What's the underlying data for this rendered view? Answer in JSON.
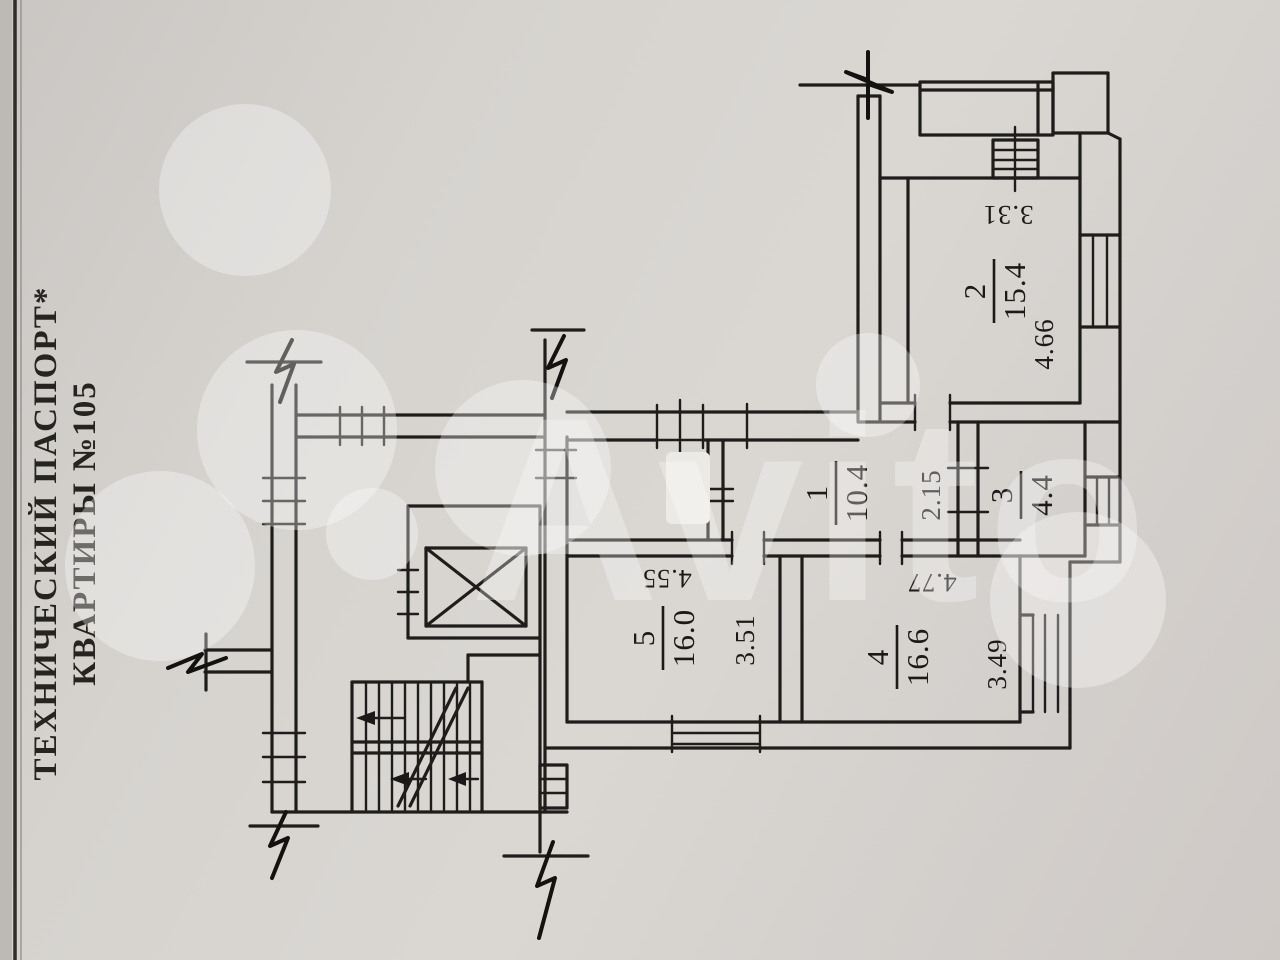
{
  "side_title": {
    "line1": "ТЕХНИЧЕСКИЙ ПАСПОРТ*",
    "line2": "КВАРТИРЫ №105"
  },
  "watermark": {
    "brand": "Avito"
  },
  "plan": {
    "rooms": {
      "r1": {
        "number": "1",
        "area": "10.4",
        "dim_depth": "2.15"
      },
      "r2": {
        "number": "2",
        "area": "15.4",
        "dim_top": "3.31",
        "dim_side": "4.66"
      },
      "r3": {
        "number": "3",
        "area": "4.4"
      },
      "r4": {
        "number": "4",
        "area": "16.6",
        "dim_top": "4.77",
        "dim_side": "3.49"
      },
      "r5": {
        "number": "5",
        "area": "16.0",
        "dim_top": "4.55",
        "dim_side": "3.51"
      }
    }
  },
  "colors": {
    "paper": "#d8d4d0",
    "ink": "#1f1d1b",
    "watermark": "#ffffff"
  }
}
